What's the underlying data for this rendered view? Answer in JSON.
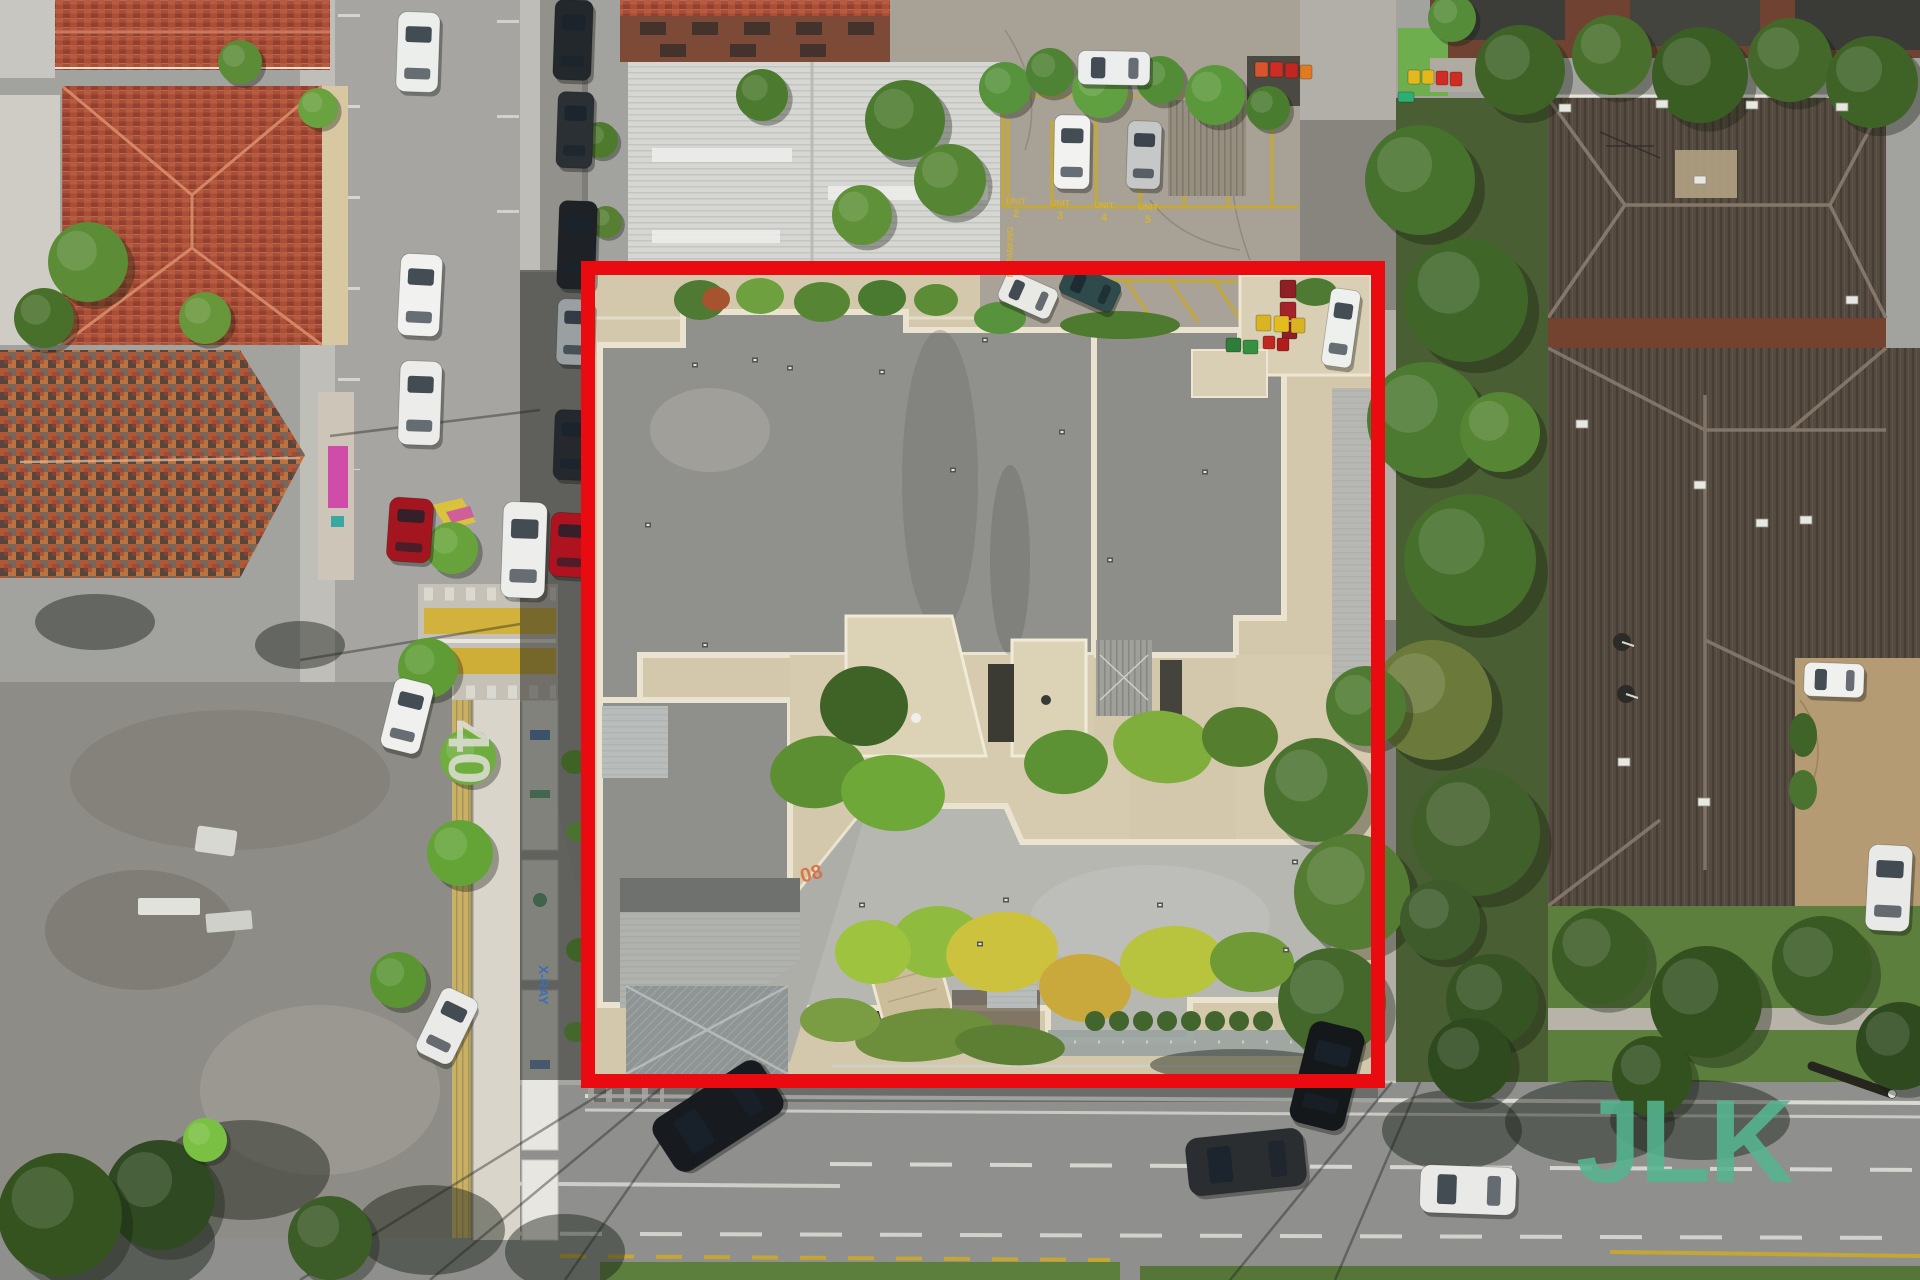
{
  "scene": {
    "description": "aerial-drone-photo-of-property-with-red-boundary",
    "palette": {
      "boundary_red": "#ea0b10",
      "watermark_green": "#55b591",
      "road_gray": "#8f908e",
      "property_paving": "#d3c8ac",
      "roof_dark_gray": "#90908c",
      "roof_light_gray": "#b7b7b2",
      "terracotta": "#a94e38",
      "brown_roof": "#554a40",
      "lawn_green": "#5d7f3e"
    },
    "boundary": {
      "x": 588,
      "y": 268,
      "width": 790,
      "height": 813,
      "color": "#ea0b10",
      "stroke_width": 14
    },
    "watermark": {
      "text": "JLK",
      "color": "#55b591",
      "opacity": 0.88,
      "x": 1576,
      "y": 1182,
      "font_size": 118,
      "font_weight": 800
    },
    "road_markings": {
      "speed_limit": {
        "text": "40",
        "x": 449,
        "y": 752,
        "rotation": 90,
        "color": "#e0dfd9",
        "font_size": 58
      },
      "unit_bays": {
        "label": "UNIT",
        "numbers": [
          "2",
          "3",
          "4",
          "5"
        ],
        "color": "#d2b23c",
        "positions": [
          [
            1016,
            204
          ],
          [
            1060,
            206
          ],
          [
            1104,
            208
          ],
          [
            1148,
            210
          ]
        ]
      },
      "no_parking": {
        "text": "NO PARKING",
        "x": 1013,
        "y": 252,
        "rotation": -90,
        "color": "#d2b23c",
        "font_size": 8
      },
      "roof_mark": {
        "text": "08",
        "x": 813,
        "y": 880,
        "rotation": -15,
        "color": "#d86a35",
        "font_size": 20
      }
    },
    "signs": {
      "xray": {
        "text": "X-RAY",
        "x": 539,
        "y": 985,
        "rotation": 90,
        "color": "#3a6fb5",
        "font_size": 13
      }
    },
    "cars": [
      [
        418,
        52,
        42,
        80,
        2,
        "#eceeec"
      ],
      [
        420,
        295,
        42,
        82,
        3,
        "#f1f2f0"
      ],
      [
        420,
        403,
        42,
        84,
        2,
        "#ecedeb"
      ],
      [
        410,
        530,
        44,
        64,
        4,
        "#a3161f"
      ],
      [
        524,
        550,
        44,
        96,
        2,
        "#ededeb"
      ],
      [
        407,
        716,
        40,
        72,
        14,
        "#f0f0ee"
      ],
      [
        447,
        1026,
        40,
        72,
        26,
        "#eaebe9"
      ],
      [
        573,
        40,
        38,
        80,
        2,
        "#23282c"
      ],
      [
        575,
        130,
        36,
        76,
        2,
        "#2b3034"
      ],
      [
        577,
        245,
        38,
        88,
        2,
        "#1e2226"
      ],
      [
        575,
        332,
        36,
        66,
        2,
        "#9aa0a2"
      ],
      [
        572,
        445,
        36,
        70,
        2,
        "#25292d"
      ],
      [
        570,
        545,
        40,
        64,
        3,
        "#b01320"
      ],
      [
        1114,
        68,
        72,
        34,
        1,
        "#eceded"
      ],
      [
        1072,
        152,
        36,
        74,
        1,
        "#f2f2f0"
      ],
      [
        1144,
        155,
        34,
        68,
        2,
        "#c6c8c7"
      ],
      [
        1028,
        295,
        56,
        32,
        24,
        "#e8e8e4"
      ],
      [
        1090,
        288,
        58,
        32,
        24,
        "#2e4a4a"
      ],
      [
        1341,
        328,
        30,
        78,
        8,
        "#eef0ee"
      ],
      [
        718,
        1116,
        128,
        62,
        -33,
        "#171b1f"
      ],
      [
        1246,
        1162,
        118,
        58,
        -6,
        "#2a2e31"
      ],
      [
        1468,
        1190,
        96,
        48,
        2,
        "#e9eae8"
      ],
      [
        1327,
        1076,
        56,
        104,
        14,
        "#14181b"
      ],
      [
        1834,
        680,
        60,
        34,
        2,
        "#f0f0ee"
      ],
      [
        1889,
        888,
        44,
        86,
        3,
        "#e9e9e7"
      ]
    ],
    "trees": [
      [
        88,
        262,
        40,
        "#5d8c37"
      ],
      [
        44,
        318,
        30,
        "#49702b"
      ],
      [
        205,
        318,
        26,
        "#68963a"
      ],
      [
        240,
        62,
        22,
        "#5d8c37"
      ],
      [
        160,
        1195,
        55,
        "#2f4a22"
      ],
      [
        60,
        1215,
        62,
        "#34531f"
      ],
      [
        205,
        1140,
        22,
        "#79c043"
      ],
      [
        330,
        1238,
        42,
        "#3c5c28"
      ],
      [
        318,
        108,
        20,
        "#6aa23f"
      ],
      [
        452,
        548,
        26,
        "#67a33a"
      ],
      [
        428,
        668,
        30,
        "#5f9c35"
      ],
      [
        468,
        757,
        28,
        "#6fae3e"
      ],
      [
        460,
        853,
        33,
        "#64a437"
      ],
      [
        398,
        980,
        28,
        "#5a9433"
      ],
      [
        905,
        120,
        40,
        "#4c7a2e"
      ],
      [
        950,
        180,
        36,
        "#568534"
      ],
      [
        862,
        215,
        30,
        "#5f9138"
      ],
      [
        762,
        95,
        26,
        "#4c7a2e"
      ],
      [
        600,
        140,
        18,
        "#4e7a2e"
      ],
      [
        606,
        222,
        16,
        "#567f33"
      ],
      [
        1005,
        88,
        26,
        "#57923c"
      ],
      [
        1050,
        72,
        24,
        "#4e8234"
      ],
      [
        1100,
        90,
        28,
        "#61a040"
      ],
      [
        1160,
        80,
        24,
        "#538c36"
      ],
      [
        1215,
        95,
        30,
        "#5b983b"
      ],
      [
        1268,
        108,
        22,
        "#4a7c30"
      ],
      [
        1520,
        70,
        45,
        "#3f6327"
      ],
      [
        1612,
        55,
        40,
        "#486f2c"
      ],
      [
        1700,
        75,
        48,
        "#3a5d24"
      ],
      [
        1790,
        60,
        42,
        "#44682a"
      ],
      [
        1872,
        82,
        46,
        "#3f6327"
      ],
      [
        1452,
        18,
        24,
        "#558c38"
      ],
      [
        1420,
        180,
        55,
        "#47722d"
      ],
      [
        1466,
        300,
        62,
        "#3f6628"
      ],
      [
        1425,
        420,
        58,
        "#4c7a31"
      ],
      [
        1470,
        560,
        66,
        "#456f2b"
      ],
      [
        1432,
        700,
        60,
        "#6b7a3a"
      ],
      [
        1476,
        832,
        64,
        "#415f2a"
      ],
      [
        1500,
        432,
        40,
        "#568534"
      ],
      [
        1316,
        790,
        52,
        "#4a7330"
      ],
      [
        1352,
        892,
        58,
        "#547c33"
      ],
      [
        1332,
        1002,
        54,
        "#44682c"
      ],
      [
        1366,
        706,
        40,
        "#4f7a31"
      ],
      [
        1600,
        956,
        48,
        "#3c5c26"
      ],
      [
        1706,
        1002,
        56,
        "#33511f"
      ],
      [
        1822,
        966,
        50,
        "#3a5a24"
      ],
      [
        1900,
        1046,
        44,
        "#2f4a1e"
      ],
      [
        1652,
        1076,
        40,
        "#33511f"
      ],
      [
        1440,
        920,
        40,
        "#3e5c2b"
      ],
      [
        1492,
        1000,
        46,
        "#365423"
      ],
      [
        1470,
        1060,
        42,
        "#2f4a1e"
      ]
    ],
    "hedges": [
      [
        818,
        772,
        48,
        36,
        -8,
        "#5c8f31"
      ],
      [
        893,
        793,
        52,
        38,
        5,
        "#6da838"
      ],
      [
        864,
        706,
        44,
        40,
        0,
        "#3f6326"
      ],
      [
        1066,
        762,
        42,
        32,
        -5,
        "#5c9134"
      ],
      [
        1163,
        747,
        50,
        36,
        8,
        "#7fae3d"
      ],
      [
        1240,
        737,
        38,
        30,
        0,
        "#557f2e"
      ],
      [
        938,
        942,
        46,
        36,
        0,
        "#8fbc3f"
      ],
      [
        1002,
        952,
        56,
        40,
        -6,
        "#cdc23e"
      ],
      [
        1085,
        988,
        46,
        34,
        4,
        "#c9a93c"
      ],
      [
        873,
        952,
        38,
        32,
        0,
        "#9ec33f"
      ],
      [
        1172,
        962,
        52,
        36,
        -4,
        "#b8c43e"
      ],
      [
        1252,
        962,
        42,
        30,
        3,
        "#6f9a35"
      ],
      [
        700,
        300,
        26,
        20,
        0,
        "#4f7a33"
      ],
      [
        760,
        296,
        24,
        18,
        0,
        "#6fa03f"
      ],
      [
        822,
        302,
        28,
        20,
        0,
        "#568534"
      ],
      [
        882,
        298,
        24,
        18,
        0,
        "#4a7a2f"
      ],
      [
        936,
        300,
        22,
        16,
        0,
        "#5d8c37"
      ],
      [
        716,
        299,
        14,
        12,
        0,
        "#a5542f"
      ],
      [
        1120,
        325,
        60,
        14,
        0,
        "#4e7a30"
      ],
      [
        1000,
        318,
        26,
        16,
        0,
        "#57923c"
      ],
      [
        1315,
        292,
        22,
        14,
        0,
        "#4f7a33"
      ],
      [
        1803,
        735,
        14,
        22,
        0,
        "#3f6328"
      ],
      [
        1803,
        790,
        14,
        20,
        0,
        "#4a7330"
      ],
      [
        575,
        762,
        14,
        12,
        0,
        "#3f6326"
      ],
      [
        578,
        832,
        12,
        10,
        0,
        "#4a7330"
      ],
      [
        580,
        950,
        14,
        12,
        0,
        "#3f6326"
      ],
      [
        576,
        1032,
        12,
        10,
        0,
        "#44682c"
      ],
      [
        925,
        1035,
        70,
        26,
        -6,
        "#6d8f3c"
      ],
      [
        1010,
        1045,
        55,
        20,
        4,
        "#5d7f33"
      ],
      [
        840,
        1020,
        40,
        22,
        0,
        "#7a9c42"
      ]
    ],
    "bottom_hedge_row": {
      "x_start": 1095,
      "x_end": 1268,
      "step": 24,
      "y": 1021,
      "r": 10,
      "fill": "#41652c"
    },
    "bins": [
      [
        1255,
        62,
        13,
        15,
        "#d8542c"
      ],
      [
        1270,
        62,
        13,
        15,
        "#cf2d23"
      ],
      [
        1285,
        63,
        13,
        15,
        "#c22620"
      ],
      [
        1300,
        65,
        12,
        14,
        "#e07b22"
      ],
      [
        1408,
        70,
        12,
        14,
        "#e3b81f"
      ],
      [
        1422,
        70,
        12,
        14,
        "#e3b81f"
      ],
      [
        1436,
        71,
        12,
        14,
        "#cf2d23"
      ],
      [
        1450,
        72,
        12,
        14,
        "#cf2d23"
      ],
      [
        1280,
        280,
        16,
        18,
        "#8e1f24"
      ],
      [
        1280,
        302,
        16,
        18,
        "#a32428"
      ],
      [
        1282,
        322,
        15,
        17,
        "#8e1f24"
      ],
      [
        1256,
        315,
        15,
        16,
        "#d8b322"
      ],
      [
        1274,
        316,
        15,
        16,
        "#e3bd1f"
      ],
      [
        1291,
        318,
        14,
        15,
        "#d8b322"
      ],
      [
        1226,
        338,
        15,
        14,
        "#2e7d3a"
      ],
      [
        1243,
        340,
        15,
        14,
        "#35903f"
      ],
      [
        1263,
        336,
        12,
        13,
        "#c22620"
      ],
      [
        1277,
        338,
        12,
        13,
        "#b01c1c"
      ],
      [
        1398,
        92,
        16,
        10,
        "#2fae74"
      ]
    ],
    "roof_vents": [
      [
        695,
        365
      ],
      [
        790,
        368
      ],
      [
        882,
        372
      ],
      [
        1062,
        432
      ],
      [
        1205,
        472
      ],
      [
        648,
        525
      ],
      [
        705,
        645
      ],
      [
        953,
        470
      ],
      [
        1110,
        560
      ],
      [
        862,
        905
      ],
      [
        1006,
        900
      ],
      [
        1160,
        905
      ],
      [
        1286,
        950
      ],
      [
        755,
        360
      ],
      [
        985,
        340
      ],
      [
        980,
        944
      ],
      [
        1295,
        862
      ]
    ],
    "ac_units": [
      [
        1565,
        108
      ],
      [
        1662,
        104
      ],
      [
        1752,
        105
      ],
      [
        1842,
        107
      ],
      [
        1582,
        424
      ],
      [
        1700,
        485
      ],
      [
        1762,
        523
      ],
      [
        1624,
        762
      ],
      [
        1704,
        802
      ],
      [
        1806,
        520
      ],
      [
        1852,
        300
      ],
      [
        1700,
        180
      ]
    ],
    "satellite_dishes": [
      [
        1622,
        642
      ],
      [
        1626,
        694
      ]
    ],
    "shadow_blobs": [
      [
        430,
        1230,
        75,
        45
      ],
      [
        565,
        1252,
        60,
        38
      ],
      [
        245,
        1170,
        85,
        50
      ],
      [
        120,
        1242,
        95,
        55
      ],
      [
        1452,
        1130,
        70,
        40
      ],
      [
        1590,
        1122,
        85,
        42
      ],
      [
        300,
        645,
        45,
        24
      ],
      [
        95,
        622,
        60,
        28
      ],
      [
        1700,
        1120,
        90,
        40
      ],
      [
        1240,
        1065,
        90,
        16
      ]
    ],
    "wire_shadows": [
      [
        620,
        1082,
        300,
        1280
      ],
      [
        668,
        1082,
        430,
        1280
      ],
      [
        702,
        1082,
        565,
        1280
      ],
      [
        1392,
        1082,
        1230,
        1280
      ],
      [
        1420,
        1082,
        1335,
        1280
      ],
      [
        520,
        624,
        300,
        660
      ],
      [
        540,
        410,
        330,
        436
      ]
    ],
    "pole_shadow": {
      "x1": 1812,
      "y1": 1066,
      "x2": 1892,
      "y2": 1094
    }
  }
}
